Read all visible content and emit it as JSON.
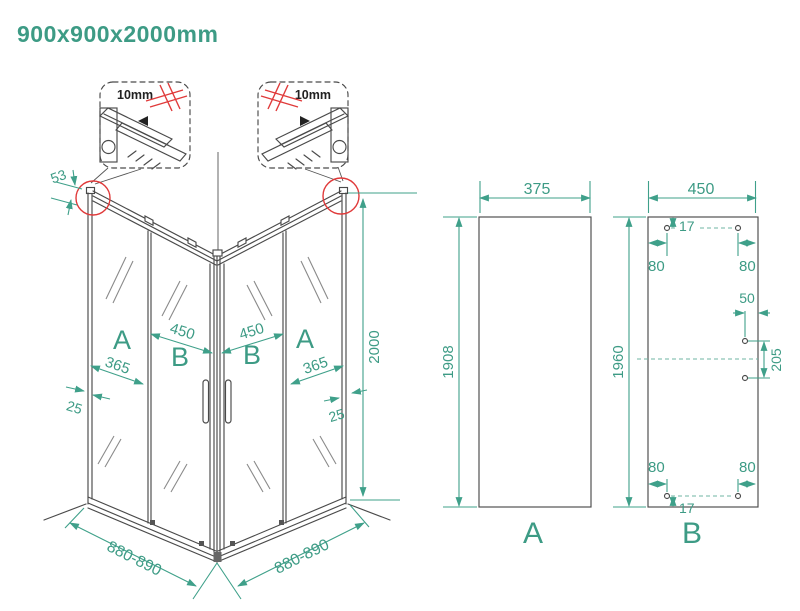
{
  "title": "900x900x2000mm",
  "accent_color": "#3d9b85",
  "line_color": "#4a4a4a",
  "highlight_color": "#e03a3a",
  "callouts": {
    "left_thickness": "10mm",
    "right_thickness": "10mm"
  },
  "iso": {
    "profile_top": "53",
    "height": "2000",
    "left": {
      "fixed_label": "A",
      "door_label": "B",
      "door_width": "450",
      "fixed_width": "365",
      "profile": "25",
      "bottom_width": "880-890"
    },
    "right": {
      "fixed_label": "A",
      "door_label": "B",
      "door_width": "450",
      "fixed_width": "365",
      "profile": "25",
      "bottom_width": "880-890"
    }
  },
  "panel_a": {
    "label": "A",
    "width": "375",
    "height": "1908"
  },
  "panel_b": {
    "label": "B",
    "width": "450",
    "height": "1960",
    "top": {
      "hole_offset": "17",
      "left_inset": "80",
      "right_inset": "80"
    },
    "side": {
      "edge_inset": "50",
      "hole_spacing": "205"
    },
    "bottom": {
      "hole_offset": "17",
      "left_inset": "80",
      "right_inset": "80"
    }
  }
}
